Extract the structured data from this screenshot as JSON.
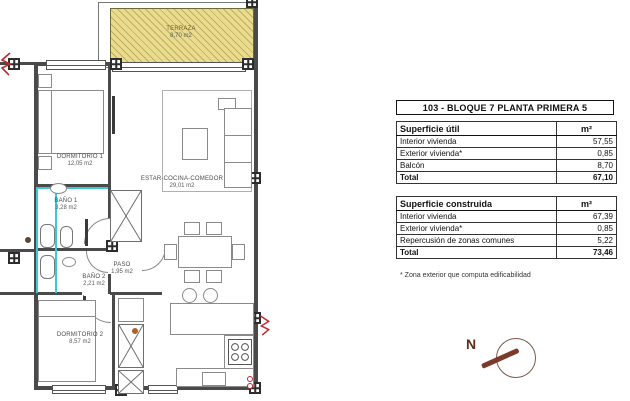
{
  "plan": {
    "rooms": {
      "terraza": {
        "name": "TERRAZA",
        "area": "8,70 m2"
      },
      "dormitorio1": {
        "name": "DORMITORIO 1",
        "area": "12,05 m2"
      },
      "bano1": {
        "name": "BAÑO 1",
        "area": "3,28 m2"
      },
      "bano2": {
        "name": "BAÑO 2",
        "area": "2,21 m2"
      },
      "paso": {
        "name": "PASO",
        "area": "1,95 m2"
      },
      "estar": {
        "name": "ESTAR-COCINA-COMEDOR",
        "area": "29,01 m2"
      },
      "dormitorio2": {
        "name": "DORMITORIO 2",
        "area": "8,57 m2"
      }
    },
    "compass": {
      "label": "N"
    }
  },
  "panel": {
    "title": "103 - BLOQUE 7 PLANTA PRIMERA 5",
    "tables": [
      {
        "header": "Superficie útil",
        "unit": "m²",
        "rows": [
          {
            "label": "Interior vivienda",
            "value": "57,55"
          },
          {
            "label": "Exterior vivienda*",
            "value": "0,85"
          },
          {
            "label": "Balcón",
            "value": "8,70"
          }
        ],
        "total_label": "Total",
        "total_value": "67,10"
      },
      {
        "header": "Superficie construida",
        "unit": "m²",
        "rows": [
          {
            "label": "Interior vivienda",
            "value": "67,39"
          },
          {
            "label": "Exterior vivienda*",
            "value": "0,85"
          },
          {
            "label": "Repercusión de zonas comunes",
            "value": "5,22"
          }
        ],
        "total_label": "Total",
        "total_value": "73,46"
      }
    ],
    "footnote": "* Zona exterior que computa edificabilidad"
  },
  "colors": {
    "terraza_fill": "#EADC8E",
    "terraza_hatch": "#9C8A3A",
    "plumbing_line": "#3EC8D6",
    "symbol_red": "#C1272D",
    "compass_brown": "#7B3A2A",
    "wall": "#4A4A4A"
  }
}
